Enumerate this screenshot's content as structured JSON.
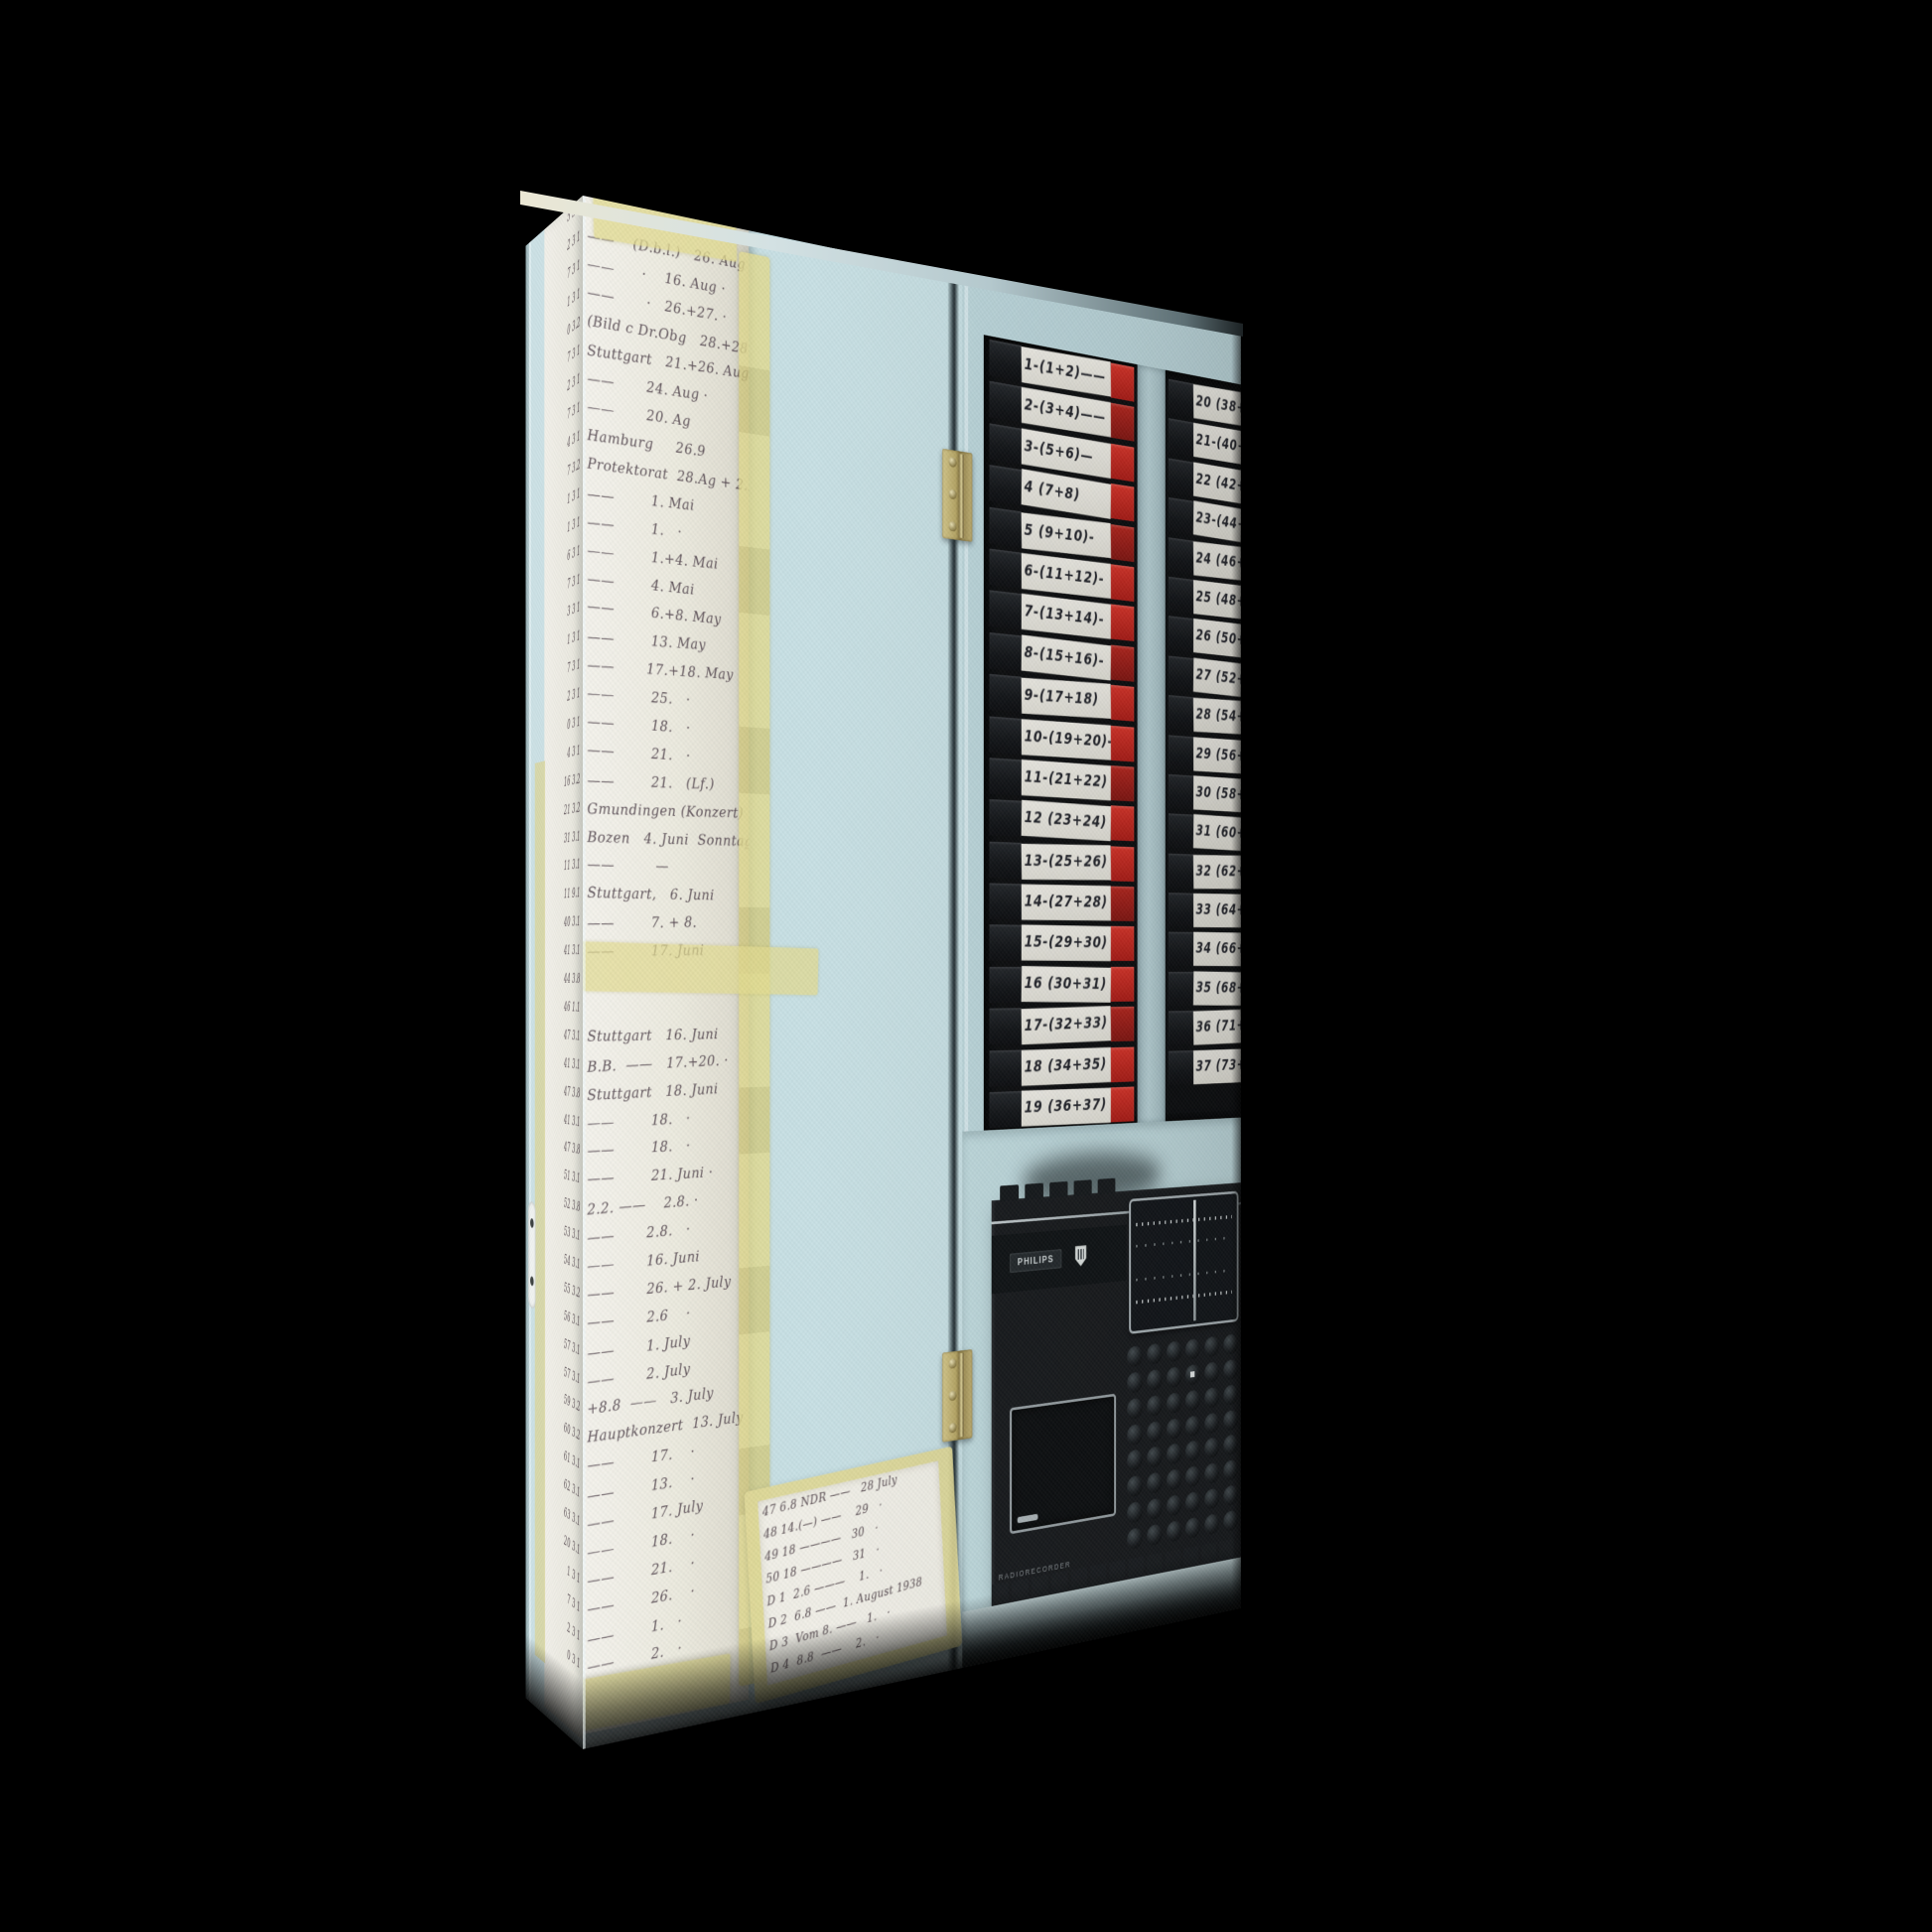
{
  "scene": {
    "description": "Canvas print photograph on black background: pale blue cabinet with taped handwritten tour ledgers, a rack of numbered cassette tapes, and a Philips radio recorder on a shelf",
    "background_color": "#000000"
  },
  "colors": {
    "wall_blue": "#c8e0e4",
    "frame_blue": "#bcd6db",
    "side_blue": "#cde2e6",
    "paper": "#f1efe7",
    "tape_yellow": "#e2da8c",
    "ink": "#584b52",
    "cassette_black": "#121417",
    "cassette_red": "#c0271d",
    "radio_black": "#17191c",
    "silver": "#aab3b7",
    "hinge_brass": "#b8a765"
  },
  "photo": {
    "ledger": {
      "lines": [
        "                 ·        —",
        "——    (D.b.l.)   26. Aug",
        "——      ·    16. Aug ·",
        "——       ·   26.+27. ·",
        "(Bild c Dr.Obg   28.+28.8)",
        "Stuttgart   21.+26. Aug ·",
        "——       24. Aug ·",
        "——       20. Ag",
        "Hamburg     26.9",
        "Protektorat  28.Ag + 2.M.",
        "——        1. Mai",
        "——        1.   ·",
        "——        1.+4. Mai",
        "——        4. Mai",
        "——        6.+8. May",
        "——        13. May",
        "——       17.+18. May",
        "——        25.   ·",
        "——        18.   ·",
        "——        21.   ·",
        "——        21.   (Lf.)",
        "Gmundingen (Konzert)",
        "Bozen   4. Juni  Sonntag",
        "——         —",
        "Stuttgart,   6. Juni",
        "——        7. + 8.",
        "——        17. Juni",
        "",
        "",
        "Stuttgart   16. Juni",
        "B.B.  ——   17.+20. ·",
        "Stuttgart   18. Juni",
        "——        18.   ·",
        "——        18.   ·",
        "——        21. Juni ·",
        "2.2. ——    2.8. ·",
        "——       2.8.   ·",
        "——       16. Juni",
        "——       26. + 2. July",
        "——       2.6    ·",
        "——       1. July",
        "——       2. July",
        "+8.8  ——   3. July",
        "Hauptkonzert  13. July",
        "——        17.    ·",
        "——        13.    ·",
        "——        17. July",
        "——        18.    ·",
        "——        21.    ·",
        "——        26.    ·",
        "——        1.   ·",
        "——        2.   ·"
      ]
    },
    "side_codes": [
      "5 3 1",
      "2 3 1",
      "7 3 1",
      "1 3 1",
      "0 3.2",
      "7 3 1",
      "2 3 1",
      "7 3 1",
      "4 3 1",
      "7 3.2",
      "1 3 1",
      "1 3 1",
      "6 3 1",
      "7 3 1",
      "3 3 1",
      "1 3 1",
      "7 3 1",
      "2 3 1",
      "0 3 1",
      "4 3 1",
      "16 3.2",
      "21 3.2",
      "31 3.1",
      "11 3.1",
      "11 9.1",
      "40 3.1",
      "41 3.1",
      "44 3.8",
      "46 1.1",
      "47 3.1",
      "41 3.1",
      "47 3.8",
      "41 3.1",
      "47 3.8",
      "51 3.1",
      "52 3.8",
      "53 3.1",
      "54 3.1",
      "55 3.2",
      "56 3.1",
      "57 3.1",
      "57 3.1",
      "59 3.2",
      "60 3.2",
      "61 3.1",
      "62 3.1",
      "63 3.1",
      "20 3.1",
      "1 3 1",
      "7 3 1",
      "2 3 1",
      "0 3 1"
    ],
    "cassette_rack": {
      "column1": [
        "1-(1+2)——",
        "2-(3+4)——",
        "3-(5+6)—",
        "4 (7+8)",
        "5 (9+10)-",
        "6-(11+12)-",
        "7-(13+14)-",
        "8-(15+16)-",
        "9-(17+18)",
        "10-(19+20)-",
        "11-(21+22)",
        "12 (23+24)",
        "13-(25+26)",
        "14-(27+28)",
        "15-(29+30)",
        "16 (30+31)",
        "17-(32+33)",
        "18 (34+35)",
        "19 (36+37)"
      ],
      "column2": [
        "20 (38+39)",
        "21-(40+41)",
        "22 (42+43)",
        "23-(44+45)",
        "24 (46+47)",
        "25 (48+49)",
        "26 (50+51)",
        "27 (52+53)",
        "28 (54+55)",
        "29 (56+57)",
        "30 (58+59)",
        "31 (60+61)",
        "32 (62+63)",
        "33 (64+65)",
        "34 (66+67)",
        "35 (68+69)",
        "36 (71+72)",
        "37 (73+74)"
      ]
    },
    "radio": {
      "brand": "PHILIPS",
      "model_text": "RADIORECORDER"
    },
    "note": {
      "lines": [
        "47 6.8 NDR ——   28 July",
        "48 14.(—) ——    29   ·",
        "49 18 ————   30   ·",
        "50 18 ————   31   ·",
        "D 1  2.6 ———    1.   ·",
        "D 2  6.8 ——  1. August 1938",
        "D 3  Vom 8. ——   1.   ·",
        "D 4  8.8  ——    2.   ·"
      ]
    }
  }
}
